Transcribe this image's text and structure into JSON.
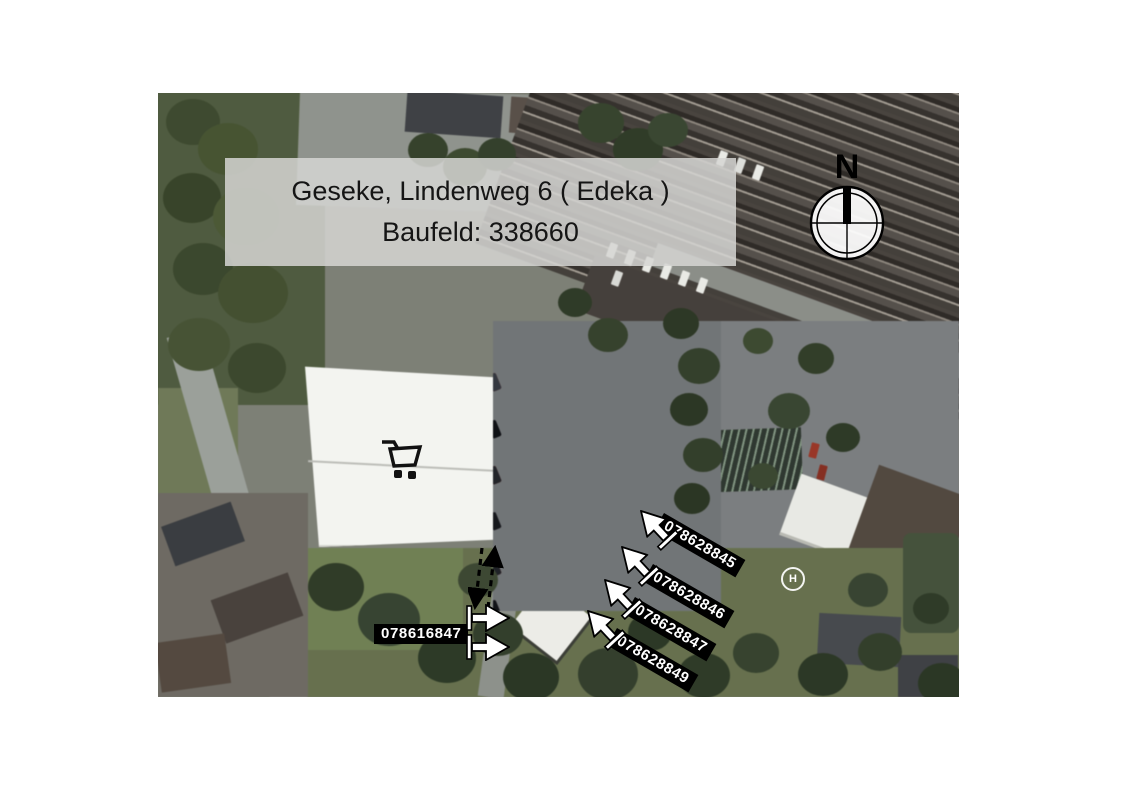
{
  "title": {
    "line1": "Geseke, Lindenweg 6 ( Edeka )",
    "line2": "Baufeld: 338660"
  },
  "compass": {
    "label": "N"
  },
  "helipad": {
    "label": "H"
  },
  "site_markers": [
    {
      "label": "078628845"
    },
    {
      "label": "078628846"
    },
    {
      "label": "078628847"
    },
    {
      "label": "078628849"
    },
    {
      "label": "078616847"
    }
  ],
  "icons": {
    "cart": "shopping-cart-icon",
    "compass": "compass-north-icon",
    "leader_arrow": "leader-arrow-icon",
    "dashed_arrow": "dashed-two-way-arrow-icon"
  },
  "colors": {
    "marker_bg": "#000000",
    "marker_text": "#ffffff",
    "title_box_bg": "#d6d6d3",
    "title_text": "#151515",
    "annotation_outline": "#000000",
    "annotation_fill": "#ffffff"
  }
}
